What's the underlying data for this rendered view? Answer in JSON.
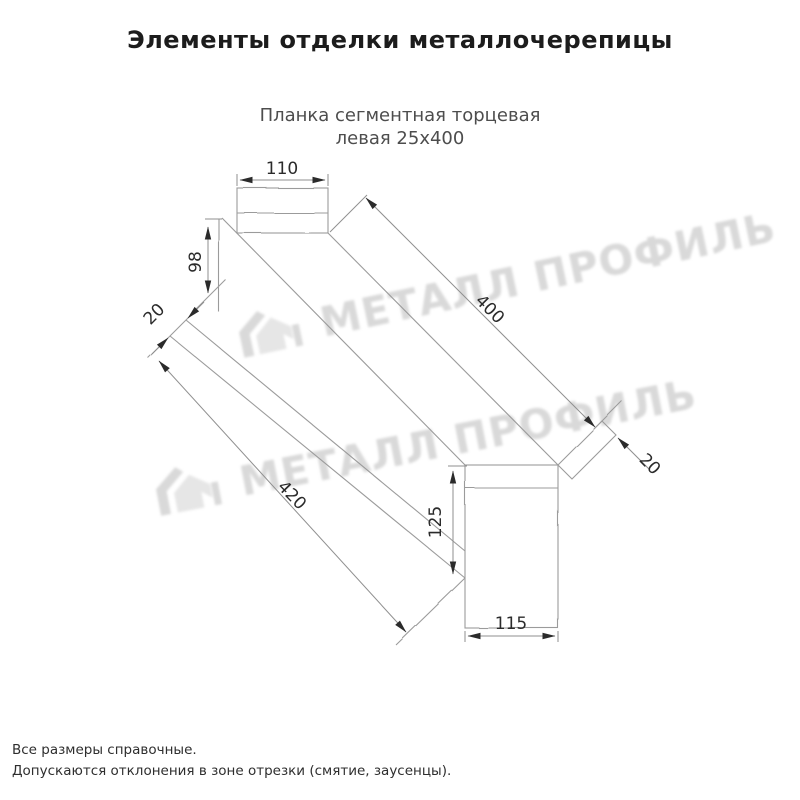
{
  "page": {
    "title": "Элементы отделки металлочерепицы"
  },
  "drawing": {
    "subtitle_line1": "Планка сегментная торцевая",
    "subtitle_line2": "левая 25х400",
    "dims": {
      "top_width": "110",
      "left_height": "98",
      "left_hem": "20",
      "top_length": "400",
      "bottom_length": "420",
      "end_height": "125",
      "end_width": "115",
      "end_hem": "20"
    },
    "watermark": {
      "text": "МЕТАЛЛ ПРОФИЛЬ",
      "logo": "metall-profil-house-logo",
      "color": "#d9d9d9"
    },
    "line_color": "#9b9b9b",
    "dim_color": "#2b2b2b"
  },
  "footnotes": {
    "line1": "Все размеры справочные.",
    "line2": "Допускаются отклонения в зоне отрезки (смятие, заусенцы)."
  }
}
